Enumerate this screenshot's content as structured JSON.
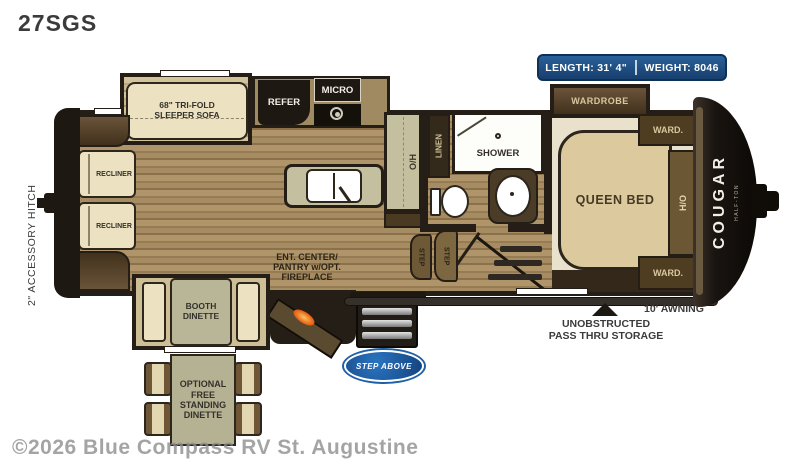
{
  "page": {
    "title": "27SGS",
    "watermark": "©2026 Blue Compass RV St. Augustine"
  },
  "specs": {
    "length": "LENGTH: 31' 4\"",
    "weight": "WEIGHT: 8046"
  },
  "exterior": {
    "hitch": "2\" ACCESSORY HITCH",
    "awning": "10' AWNING",
    "passthru_line1": "UNOBSTRUCTED",
    "passthru_line2": "PASS THRU STORAGE",
    "brand": "COUGAR",
    "brand_sub": "HALF-TON",
    "entry_logo": "STEP ABOVE"
  },
  "rooms": {
    "living": {
      "recliner1": "RECLINER",
      "recliner2": "RECLINER",
      "sofa": "68\" TRI-FOLD SLEEPER SOFA",
      "booth": "BOOTH DINETTE",
      "ent1": "ENT. CENTER/",
      "ent2": "PANTRY w/OPT.",
      "ent3": "FIREPLACE",
      "optional_dinette": "OPTIONAL FREE STANDING DINETTE"
    },
    "kitchen": {
      "refer": "REFER",
      "micro": "MICRO",
      "overhead": "O/H"
    },
    "bath": {
      "linen": "LINEN",
      "shower": "SHOWER",
      "step1": "STEP",
      "step2": "STEP"
    },
    "bedroom": {
      "wardrobe_slide": "WARDROBE",
      "ward_top": "WARD.",
      "ward_bottom": "WARD.",
      "overhead": "H/O",
      "bed": "QUEEN BED"
    }
  },
  "colors": {
    "badge_blue": "#1b4a80",
    "logo_blue": "#1f5fa8",
    "flame_orange": "#e2590f"
  }
}
